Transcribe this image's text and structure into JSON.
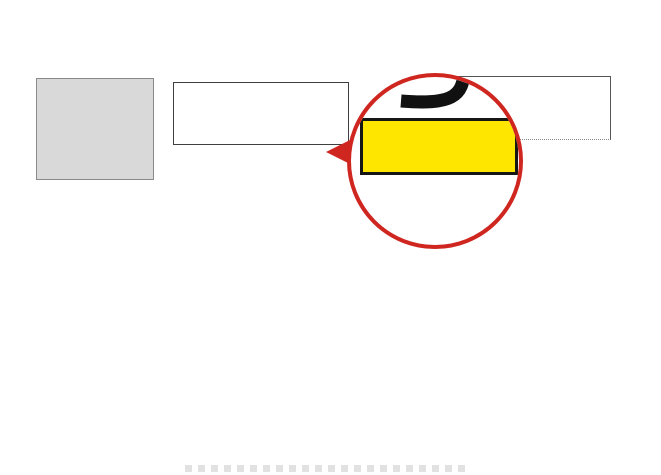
{
  "header": {
    "title": "展位号：9A12"
  },
  "signs": {
    "hall7_line1": "从7号展馆",
    "hall7_line2": "进入9号馆",
    "hall8": "8号展馆",
    "logistics": "智能物流展区",
    "gate_left": "9-10门",
    "gate_right": "9-01门",
    "gate_bottom": "9-0",
    "to_hall1": "往1号馆",
    "escalator_left": "自动扶梯",
    "escalator_right": "自动扶梯"
  },
  "magnifier": {
    "star": "★",
    "exhibitor": "信成",
    "booth_no": "9A12"
  },
  "colors": {
    "accent_red": "#c5281f",
    "highlight_yellow": "#ffe600",
    "marker_blue": "#1f86d6",
    "logistics_blue": "#5b9bd5",
    "title_red": "#ee1111"
  },
  "map": {
    "booths": [
      {
        "id": "yiwei",
        "x": 177,
        "y": 143,
        "w": 22,
        "h": 20,
        "name": "颐伟",
        "fs": 6
      },
      {
        "id": "9a03",
        "x": 199,
        "y": 143,
        "w": 23,
        "h": 20,
        "name": "9A03",
        "fs": 6
      },
      {
        "id": "hongtai",
        "x": 222,
        "y": 143,
        "w": 23,
        "h": 20,
        "name": "鸿泰",
        "fs": 6
      },
      {
        "id": "xincheng-highlight",
        "x": 273,
        "y": 143,
        "w": 46,
        "h": 20,
        "name": "信成",
        "star": "★",
        "yellow": true,
        "fs": 10
      },
      {
        "id": "changyuan",
        "x": 204,
        "y": 168,
        "w": 45,
        "h": 29,
        "name": "常远",
        "size": "9x6",
        "fs": 10
      },
      {
        "id": "cell-9x6-a",
        "x": 280,
        "y": 168,
        "w": 47,
        "h": 29,
        "size": "9x6",
        "fs": 8
      },
      {
        "id": "yt",
        "x": 48,
        "y": 213,
        "w": 27,
        "h": 57,
        "name": "YT",
        "sub": "（盈速）",
        "size": "4x12",
        "limit": "限高4米",
        "fs": 9
      },
      {
        "id": "dazhaohe",
        "x": 84,
        "y": 213,
        "w": 30,
        "h": 57,
        "name": "大昭和",
        "size": "6x12",
        "limit": "限高4米",
        "fs": 8
      },
      {
        "id": "yisika",
        "x": 121,
        "y": 213,
        "w": 30,
        "h": 57,
        "name": "伊斯卡",
        "sub": "（锐锋）",
        "code": "9A34",
        "size": "6x12",
        "limit": "限高4米",
        "fs": 8
      },
      {
        "id": "youneng",
        "x": 158,
        "y": 213,
        "w": 32,
        "h": 57,
        "name": "佑能",
        "sub": "（圣峰达）",
        "code": "9A42",
        "size": "6x12",
        "limit": "限高3米",
        "fs": 9
      },
      {
        "id": "palaike",
        "x": 207,
        "y": 233,
        "w": 58,
        "h": 39,
        "name": "帕莱克",
        "sub": "（爱普生）",
        "size": "12x8",
        "fs": 11
      },
      {
        "id": "platit",
        "x": 283,
        "y": 208,
        "w": 72,
        "h": 59,
        "name": "PLATIT",
        "sub": "（普兰地）",
        "code": "9A59",
        "size": "15x12",
        "fs": 12
      },
      {
        "id": "column-3x3",
        "x": 337,
        "y": 208,
        "w": 15,
        "h": 14,
        "name": "3x3",
        "sub": "圆形柱",
        "fs": 4,
        "dashed": true
      },
      {
        "id": "cell-6x12-a",
        "x": 373,
        "y": 245,
        "w": 34,
        "h": 28,
        "size": "6x12",
        "fs": 7
      },
      {
        "id": "cell-6x12-b",
        "x": 410,
        "y": 245,
        "w": 31,
        "h": 28,
        "size": "6x12",
        "fs": 7
      },
      {
        "id": "cell-6x12-c",
        "x": 449,
        "y": 245,
        "w": 32,
        "h": 28,
        "size": "6x12",
        "fs": 7
      },
      {
        "id": "cell-14x8",
        "x": 483,
        "y": 246,
        "w": 47,
        "h": 27,
        "size": "14x8",
        "fs": 7,
        "dashed": true
      },
      {
        "id": "cell-top-right",
        "x": 527,
        "y": 142,
        "w": 25,
        "h": 28,
        "fs": 7
      },
      {
        "id": "cell-9x6-b",
        "x": 568,
        "y": 142,
        "w": 42,
        "h": 28,
        "size": "9x6",
        "fs": 7
      },
      {
        "id": "cell-6x6",
        "x": 578,
        "y": 190,
        "w": 30,
        "h": 33,
        "size": "6x6",
        "fs": 7
      },
      {
        "id": "cell-6x9",
        "x": 578,
        "y": 228,
        "w": 27,
        "h": 44,
        "size": "6x9",
        "fs": 7
      },
      {
        "id": "bilz",
        "x": 50,
        "y": 299,
        "w": 14,
        "h": 72,
        "name": "BILZ",
        "size": "3x14",
        "codeBottom": "9C05",
        "fs": 6,
        "vert": true
      },
      {
        "id": "shanteweike",
        "x": 78,
        "y": 299,
        "w": 32,
        "h": 69,
        "name": "山特\n维克",
        "size": "6x15",
        "fs": 10
      },
      {
        "id": "yg",
        "x": 120,
        "y": 297,
        "w": 32,
        "h": 71,
        "name": "YG",
        "sub": "（养志园）",
        "code": "9C20",
        "size": "6x15",
        "fs": 12
      },
      {
        "id": "depo",
        "x": 163,
        "y": 297,
        "w": 44,
        "h": 71,
        "name": "DEPO",
        "sub": "（希普思）",
        "code": "9C30",
        "size": "9x15",
        "fs": 12
      },
      {
        "id": "dhf",
        "x": 217,
        "y": 297,
        "w": 30,
        "h": 71,
        "name": "DHF",
        "sub": "（德瑞）",
        "code": "9C45",
        "size": "6x15",
        "fs": 11
      },
      {
        "id": "waerte",
        "x": 258,
        "y": 298,
        "w": 31,
        "h": 70,
        "name": "瓦尔特",
        "sub": "（唐田）",
        "size": "6x15",
        "fs": 9
      },
      {
        "id": "senlatianshi",
        "x": 304,
        "y": 301,
        "w": 32,
        "h": 41,
        "name": "森拉\n天时",
        "sub": "（春保）",
        "size": "6x9",
        "fs": 9
      },
      {
        "id": "beijingshidai",
        "x": 304,
        "y": 342,
        "w": 32,
        "h": 26,
        "name": "北京\n时代",
        "fs": 9
      },
      {
        "id": "rili",
        "x": 352,
        "y": 305,
        "w": 29,
        "h": 37,
        "name": "日立",
        "sub": "（赏立）",
        "size": "6x9",
        "fs": 9
      },
      {
        "id": "yazhoukehui",
        "x": 352,
        "y": 342,
        "w": 29,
        "h": 26,
        "name": "亚洲\n科汇",
        "fs": 8
      },
      {
        "id": "daijie",
        "x": 390,
        "y": 298,
        "w": 29,
        "h": 42,
        "name": "黛杰",
        "sub": "（东建）",
        "size": "6x9",
        "fs": 9
      },
      {
        "id": "hongju",
        "x": 390,
        "y": 342,
        "w": 29,
        "h": 26,
        "name": "虹钜",
        "fs": 9
      },
      {
        "id": "yamawa",
        "x": 432,
        "y": 298,
        "w": 32,
        "h": 42,
        "name": "YAMAWA",
        "sub": "（唐锐得）",
        "size": "6x9",
        "fs": 7
      },
      {
        "id": "yibote",
        "x": 432,
        "y": 342,
        "w": 32,
        "h": 26,
        "name": "伊伯特",
        "fs": 8
      },
      {
        "id": "zhuyou",
        "x": 477,
        "y": 297,
        "w": 28,
        "h": 43,
        "name": "住友",
        "sub": "（正铨）",
        "size": "6x9",
        "fs": 9
      },
      {
        "id": "hengkai",
        "x": 477,
        "y": 342,
        "w": 28,
        "h": 26,
        "name": "恒凯",
        "fs": 9
      },
      {
        "id": "lanzhi",
        "x": 517,
        "y": 297,
        "w": 30,
        "h": 43,
        "name": "蓝帜",
        "sub": "（德和美）",
        "size": "6x9",
        "fs": 9
      },
      {
        "id": "dadihejin",
        "x": 517,
        "y": 342,
        "w": 30,
        "h": 26,
        "name": "大地\n合金",
        "fs": 9
      },
      {
        "id": "zhongji",
        "x": 559,
        "y": 297,
        "w": 30,
        "h": 41,
        "name": "中机",
        "size": "6x9",
        "fs": 9
      },
      {
        "id": "xintaifeng",
        "x": 559,
        "y": 340,
        "w": 30,
        "h": 28,
        "name": "欣泰丰",
        "fs": 8
      },
      {
        "id": "shiwacike",
        "x": 603,
        "y": 298,
        "w": 15,
        "h": 40,
        "name": "施瓦茨克",
        "fs": 5,
        "vert": true
      },
      {
        "id": "wanshida",
        "x": 603,
        "y": 338,
        "w": 15,
        "h": 24,
        "name": "万事达",
        "fs": 5,
        "vert": true
      },
      {
        "id": "sf65",
        "x": 603,
        "y": 362,
        "w": 15,
        "h": 12,
        "name": "SF65",
        "fs": 4
      },
      {
        "id": "songzhan",
        "x": 603,
        "y": 374,
        "w": 15,
        "h": 12,
        "name": "颂展",
        "fs": 4
      },
      {
        "id": "liyou",
        "x": 48,
        "y": 378,
        "w": 20,
        "h": 50,
        "name": "利优",
        "size": "3x12",
        "fs": 8,
        "vert": true
      },
      {
        "id": "haoen",
        "x": 77,
        "y": 388,
        "w": 33,
        "h": 50,
        "name": "号恩",
        "size": "6x12",
        "fs": 10
      },
      {
        "id": "beipingjichuang",
        "x": 117,
        "y": 380,
        "w": 32,
        "h": 58,
        "name": "北平\n机床",
        "code": "9H09",
        "size": "6x12",
        "fs": 9
      },
      {
        "id": "jingzhan",
        "x": 156,
        "y": 380,
        "w": 32,
        "h": 58,
        "name": "精展",
        "code": "9H17",
        "size": "6x12",
        "fs": 10
      },
      {
        "id": "mingguwu",
        "x": 200,
        "y": 382,
        "w": 31,
        "h": 56,
        "name": "名古屋",
        "size": "6x12",
        "fs": 9
      },
      {
        "id": "bentu",
        "x": 242,
        "y": 382,
        "w": 31,
        "h": 56,
        "name": "本土",
        "size": "6x12",
        "fs": 10
      },
      {
        "id": "hale",
        "x": 283,
        "y": 382,
        "w": 30,
        "h": 56,
        "name": "哈勒",
        "size": "6x12",
        "fs": 10
      },
      {
        "id": "hafuman",
        "x": 321,
        "y": 384,
        "w": 27,
        "h": 36,
        "name": "哈夫曼",
        "code": "9H49",
        "size": "6x6",
        "fs": 6
      },
      {
        "id": "dajing",
        "x": 357,
        "y": 382,
        "w": 29,
        "h": 58,
        "name": "大井",
        "size": "6x12",
        "fs": 10
      },
      {
        "id": "fanmei",
        "x": 395,
        "y": 382,
        "w": 29,
        "h": 58,
        "name": "泛美",
        "size": "6x12",
        "fs": 10
      },
      {
        "id": "juzhen",
        "x": 436,
        "y": 380,
        "w": 30,
        "h": 60,
        "name": "钜振",
        "code": "9K17",
        "size": "6x12",
        "fs": 10
      },
      {
        "id": "aiweiboer",
        "x": 479,
        "y": 382,
        "w": 32,
        "h": 58,
        "name": "艾威\n博尔",
        "fs": 10
      },
      {
        "id": "wenlinglifeng",
        "x": 521,
        "y": 382,
        "w": 31,
        "h": 58,
        "name": "温岭\n力锋",
        "fs": 10
      },
      {
        "id": "jinghong",
        "x": 561,
        "y": 380,
        "w": 27,
        "h": 58,
        "name": "晶鸿",
        "fs": 10
      },
      {
        "id": "puweite",
        "x": 604,
        "y": 374,
        "w": 16,
        "h": 44,
        "name": "普威特",
        "fs": 6,
        "vert": true
      }
    ],
    "labels": [
      {
        "t": "9A",
        "x": 158,
        "y": 147,
        "fs": 10
      },
      {
        "t": "9A",
        "x": 190,
        "y": 155,
        "fs": 13
      },
      {
        "t": "9A",
        "x": 44,
        "y": 200,
        "fs": 12
      },
      {
        "t": "9A",
        "x": 203,
        "y": 221,
        "fs": 12
      },
      {
        "t": "9A",
        "x": 280,
        "y": 196,
        "fs": 12
      },
      {
        "t": "9C",
        "x": 64,
        "y": 286,
        "fs": 12
      },
      {
        "t": "9C",
        "x": 290,
        "y": 291,
        "fs": 12
      },
      {
        "t": "9F",
        "x": 337,
        "y": 294,
        "fs": 12
      },
      {
        "t": "9F",
        "x": 583,
        "y": 275,
        "fs": 12
      },
      {
        "t": "9H",
        "x": 66,
        "y": 372,
        "fs": 11
      },
      {
        "t": "9H",
        "x": 311,
        "y": 379,
        "fs": 11
      },
      {
        "t": "9K",
        "x": 347,
        "y": 374,
        "fs": 11
      }
    ],
    "arrows": [
      {
        "dir": "down",
        "x": 154,
        "y": 120,
        "len": 40
      },
      {
        "dir": "down",
        "x": 252,
        "y": 142,
        "len": 29
      },
      {
        "dir": "down",
        "x": 549,
        "y": 136,
        "len": 34
      },
      {
        "dir": "vd",
        "x": 268,
        "y": 193,
        "len": 52
      },
      {
        "dir": "vd",
        "x": 556,
        "y": 196,
        "len": 52
      },
      {
        "dir": "left",
        "x": 54,
        "y": 263,
        "len": 56
      },
      {
        "dir": "left",
        "x": 44,
        "y": 449,
        "len": 34
      },
      {
        "dir": "right",
        "x": 220,
        "y": 212,
        "len": 40
      },
      {
        "dir": "right",
        "x": 524,
        "y": 211,
        "len": 36
      }
    ],
    "icons": [
      {
        "type": "esc",
        "x": 100,
        "y": 170,
        "w": 32,
        "h": 26
      },
      {
        "type": "esc",
        "x": 181,
        "y": 169,
        "w": 21,
        "h": 27
      },
      {
        "type": "esc",
        "x": 613,
        "y": 169,
        "w": 24,
        "h": 22
      },
      {
        "type": "ramp",
        "x": 212,
        "y": 212,
        "w": 52,
        "h": 15
      },
      {
        "type": "ramp",
        "x": 519,
        "y": 211,
        "w": 46,
        "h": 15
      },
      {
        "type": "door",
        "x": 24,
        "y": 262,
        "w": 20,
        "h": 28,
        "flip": false
      },
      {
        "type": "door",
        "x": 26,
        "y": 436,
        "w": 20,
        "h": 24,
        "flip": false
      },
      {
        "type": "door",
        "x": 613,
        "y": 268,
        "w": 14,
        "h": 27,
        "flip": true
      },
      {
        "type": "door",
        "x": 615,
        "y": 443,
        "w": 12,
        "h": 16,
        "flip": true
      },
      {
        "type": "blue",
        "x": 614,
        "y": 211,
        "w": 13,
        "h": 13
      },
      {
        "type": "blue",
        "x": 47,
        "y": 427,
        "w": 12,
        "h": 14
      },
      {
        "type": "blue",
        "x": 615,
        "y": 427,
        "w": 13,
        "h": 14
      },
      {
        "type": "marker",
        "x": 318,
        "y": 420,
        "w": 36,
        "h": 22
      },
      {
        "type": "smallbox",
        "x": 148,
        "y": 193,
        "w": 13,
        "h": 9
      }
    ],
    "dots": [
      [
        82,
        208
      ],
      [
        155,
        206
      ],
      [
        155,
        226
      ],
      [
        52,
        296
      ],
      [
        341,
        269
      ],
      [
        342,
        289
      ],
      [
        334,
        444
      ],
      [
        50,
        236
      ]
    ],
    "lines": [
      {
        "x": 44,
        "y": 230,
        "w": 0,
        "h": 242,
        "dotted": false
      },
      {
        "x": 628,
        "y": 186,
        "w": 0,
        "h": 284,
        "dotted": false
      },
      {
        "x": 605,
        "y": 142,
        "w": 0,
        "h": 290,
        "dotted": true
      }
    ]
  }
}
